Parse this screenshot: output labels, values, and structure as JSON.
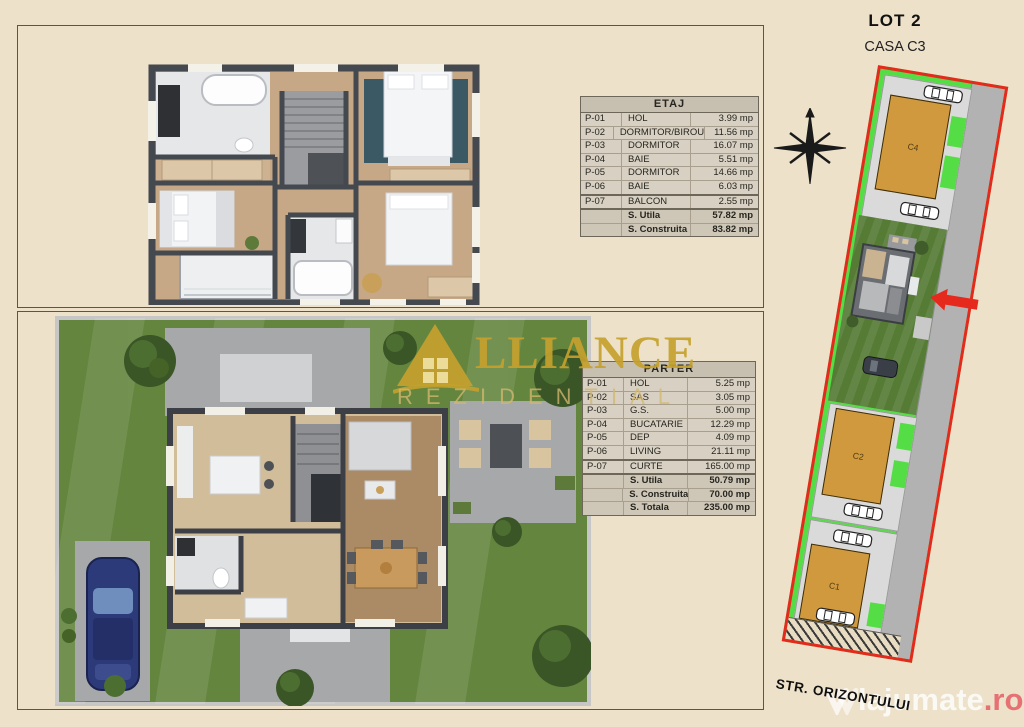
{
  "header": {
    "lot_title": "LOT 2",
    "casa_subtitle": "CASA C3"
  },
  "etaj_table": {
    "title": "ETAJ",
    "rows": [
      {
        "code": "P-01",
        "name": "HOL",
        "area": "3.99 mp"
      },
      {
        "code": "P-02",
        "name": "DORMITOR/BIROU",
        "area": "11.56 mp"
      },
      {
        "code": "P-03",
        "name": "DORMITOR",
        "area": "16.07 mp"
      },
      {
        "code": "P-04",
        "name": "BAIE",
        "area": "5.51 mp"
      },
      {
        "code": "P-05",
        "name": "DORMITOR",
        "area": "14.66 mp"
      },
      {
        "code": "P-06",
        "name": "BAIE",
        "area": "6.03 mp"
      },
      {
        "code": "P-07",
        "name": "BALCON",
        "area": "2.55 mp"
      }
    ],
    "totals": [
      {
        "name": "S. Utila",
        "area": "57.82 mp"
      },
      {
        "name": "S. Construita",
        "area": "83.82 mp"
      }
    ]
  },
  "parter_table": {
    "title": "PARTER",
    "rows": [
      {
        "code": "P-01",
        "name": "HOL",
        "area": "5.25 mp"
      },
      {
        "code": "P-02",
        "name": "SAS",
        "area": "3.05 mp"
      },
      {
        "code": "P-03",
        "name": "G.S.",
        "area": "5.00 mp"
      },
      {
        "code": "P-04",
        "name": "BUCATARIE",
        "area": "12.29 mp"
      },
      {
        "code": "P-05",
        "name": "DEP",
        "area": "4.09 mp"
      },
      {
        "code": "P-06",
        "name": "LIVING",
        "area": "21.11 mp"
      },
      {
        "code": "P-07",
        "name": "CURTE",
        "area": "165.00 mp"
      }
    ],
    "totals": [
      {
        "name": "S. Utila",
        "area": "50.79 mp"
      },
      {
        "name": "S. Construita",
        "area": "70.00 mp"
      },
      {
        "name": "S. Totala",
        "area": "235.00 mp"
      }
    ]
  },
  "logo": {
    "brand": "ALLIANCE",
    "brand_visible": "LLIANCE",
    "subtitle": "REZIDENTIAL"
  },
  "site_plan": {
    "lot_c4": "C4",
    "lot_c2": "C2",
    "lot_c1": "C1",
    "highlighted_lot": "C3"
  },
  "street_label": "STR. ORIZONTULUI",
  "watermark": {
    "text": "lajumate",
    "tld": ".ro"
  },
  "colors": {
    "background": "#ede1c9",
    "accent_red": "#e6291d",
    "brand_gold": "#c4a12c",
    "site_green": "#55dd45",
    "road_gray": "#b2b2b2",
    "courtyard_gray": "#dadada",
    "house_orange": "#d0993e"
  }
}
